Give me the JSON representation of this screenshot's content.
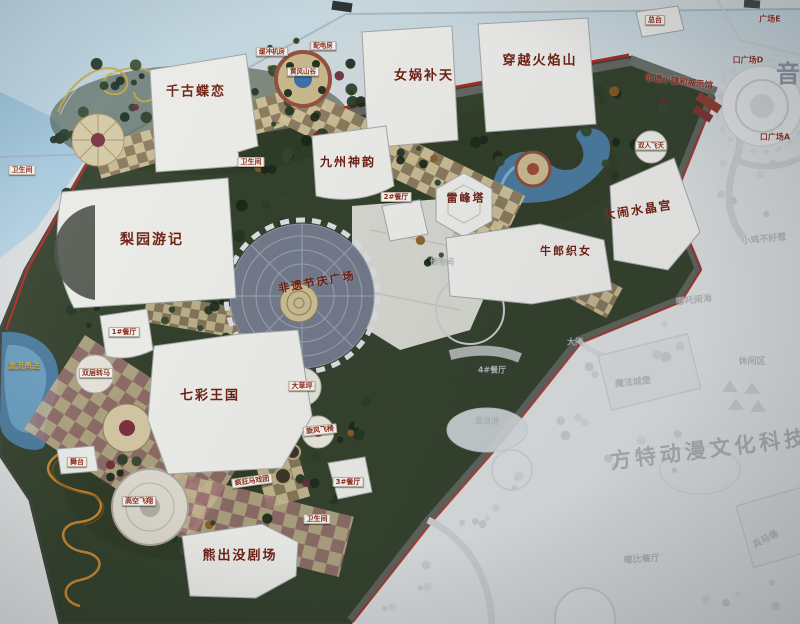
{
  "map": {
    "description_kind": "theme-park-master-plan-photo",
    "colors": {
      "park_green": "#33402c",
      "boundary_red": "#a32c24",
      "water_blue": "#49799c",
      "walkway_tan": "#cdbf96",
      "walkway_brown": "#8d7b5f",
      "major_label_red": "#6e2013",
      "faded_text_gray": "#aeb3b6",
      "sign_blue": "#8fb9d2"
    }
  },
  "labels": [
    {
      "id": "qiangu-dielian",
      "text": "千古蝶恋",
      "kind": "major"
    },
    {
      "id": "nvwa-butian",
      "text": "女娲补天",
      "kind": "major"
    },
    {
      "id": "chuanyue-huoyanshan",
      "text": "穿越火焰山",
      "kind": "major"
    },
    {
      "id": "jiuzhou-shenyun",
      "text": "九州神韵",
      "kind": "major"
    },
    {
      "id": "liyuan-youji",
      "text": "梨园游记",
      "kind": "major"
    },
    {
      "id": "leifengta",
      "text": "雷峰塔",
      "kind": "major"
    },
    {
      "id": "danao-shuijinggong",
      "text": "大闹水晶宫",
      "kind": "major"
    },
    {
      "id": "niulang-zhinv",
      "text": "牛郎织女",
      "kind": "major"
    },
    {
      "id": "feiyi-jieqing-guangchang",
      "text": "非遗节庆广场",
      "kind": "major"
    },
    {
      "id": "qicai-wangguo",
      "text": "七彩王国",
      "kind": "major"
    },
    {
      "id": "xiongchumo-juchang",
      "text": "熊出没剧场",
      "kind": "major"
    },
    {
      "id": "feiyi-xiaozhen-zhanshiguan",
      "text": "非遗小镇和展示馆",
      "kind": "edge"
    },
    {
      "id": "zongtai",
      "text": "总台",
      "kind": "flag"
    },
    {
      "id": "guangchang-e",
      "text": "广场E",
      "kind": "edge"
    },
    {
      "id": "rukou-guangchang-d",
      "text": "口广场D",
      "kind": "edge"
    },
    {
      "id": "rukou-guangchang-a",
      "text": "口广场A",
      "kind": "edge"
    },
    {
      "id": "yinyue-char",
      "text": "音",
      "kind": "bigchar"
    },
    {
      "id": "weishengjian-1",
      "text": "卫生间",
      "kind": "flag"
    },
    {
      "id": "weishengjian-2",
      "text": "卫生间",
      "kind": "flag"
    },
    {
      "id": "weishengjian-3",
      "text": "卫生间",
      "kind": "flag"
    },
    {
      "id": "canting-2",
      "text": "2#餐厅",
      "kind": "flag"
    },
    {
      "id": "canting-1",
      "text": "1#餐厅",
      "kind": "flag"
    },
    {
      "id": "canting-3",
      "text": "3#餐厅",
      "kind": "flag"
    },
    {
      "id": "shuangceng-zhuanma",
      "text": "双层转马",
      "kind": "flag"
    },
    {
      "id": "dacaoping",
      "text": "大草坪",
      "kind": "flag"
    },
    {
      "id": "xuanfeng-feiyi",
      "text": "旋风飞椅",
      "kind": "flag"
    },
    {
      "id": "fengkuang-maxituan",
      "text": "疯狂马戏团",
      "kind": "flag"
    },
    {
      "id": "gaokong-feixiang",
      "text": "高空飞翔",
      "kind": "flag"
    },
    {
      "id": "wutai",
      "text": "舞台",
      "kind": "flag"
    },
    {
      "id": "jiliu-yongjin",
      "text": "激流勇进",
      "kind": "ground"
    },
    {
      "id": "shuangren-feitian",
      "text": "双人飞天",
      "kind": "flag"
    },
    {
      "id": "huanchong-jifang",
      "text": "缓冲机房",
      "kind": "flag"
    },
    {
      "id": "peidianfang",
      "text": "配电房",
      "kind": "flag"
    },
    {
      "id": "huangfeng-shangu",
      "text": "黄风山谷",
      "kind": "flag"
    },
    {
      "id": "chuwujian",
      "text": "储物间",
      "kind": "faded"
    },
    {
      "id": "canting-4",
      "text": "4#餐厅",
      "kind": "faded"
    },
    {
      "id": "zaolangchi",
      "text": "造浪池",
      "kind": "faded"
    },
    {
      "id": "mofa-chengbao",
      "text": "魔法城堡",
      "kind": "faded"
    },
    {
      "id": "damen",
      "text": "大门",
      "kind": "faded"
    },
    {
      "id": "xiaoji-buhaore",
      "text": "小鸡不好惹",
      "kind": "faded"
    },
    {
      "id": "nezha-naohai",
      "text": "哪吒闹海",
      "kind": "faded"
    },
    {
      "id": "xiuxianqu",
      "text": "休闲区",
      "kind": "faded"
    },
    {
      "id": "dubi-canting",
      "text": "嘟比餐厅",
      "kind": "faded"
    },
    {
      "id": "bingmayong",
      "text": "兵马俑",
      "kind": "faded"
    },
    {
      "id": "fangte-watermark",
      "text": "方特动漫文化科技园",
      "kind": "fadedbig"
    }
  ]
}
